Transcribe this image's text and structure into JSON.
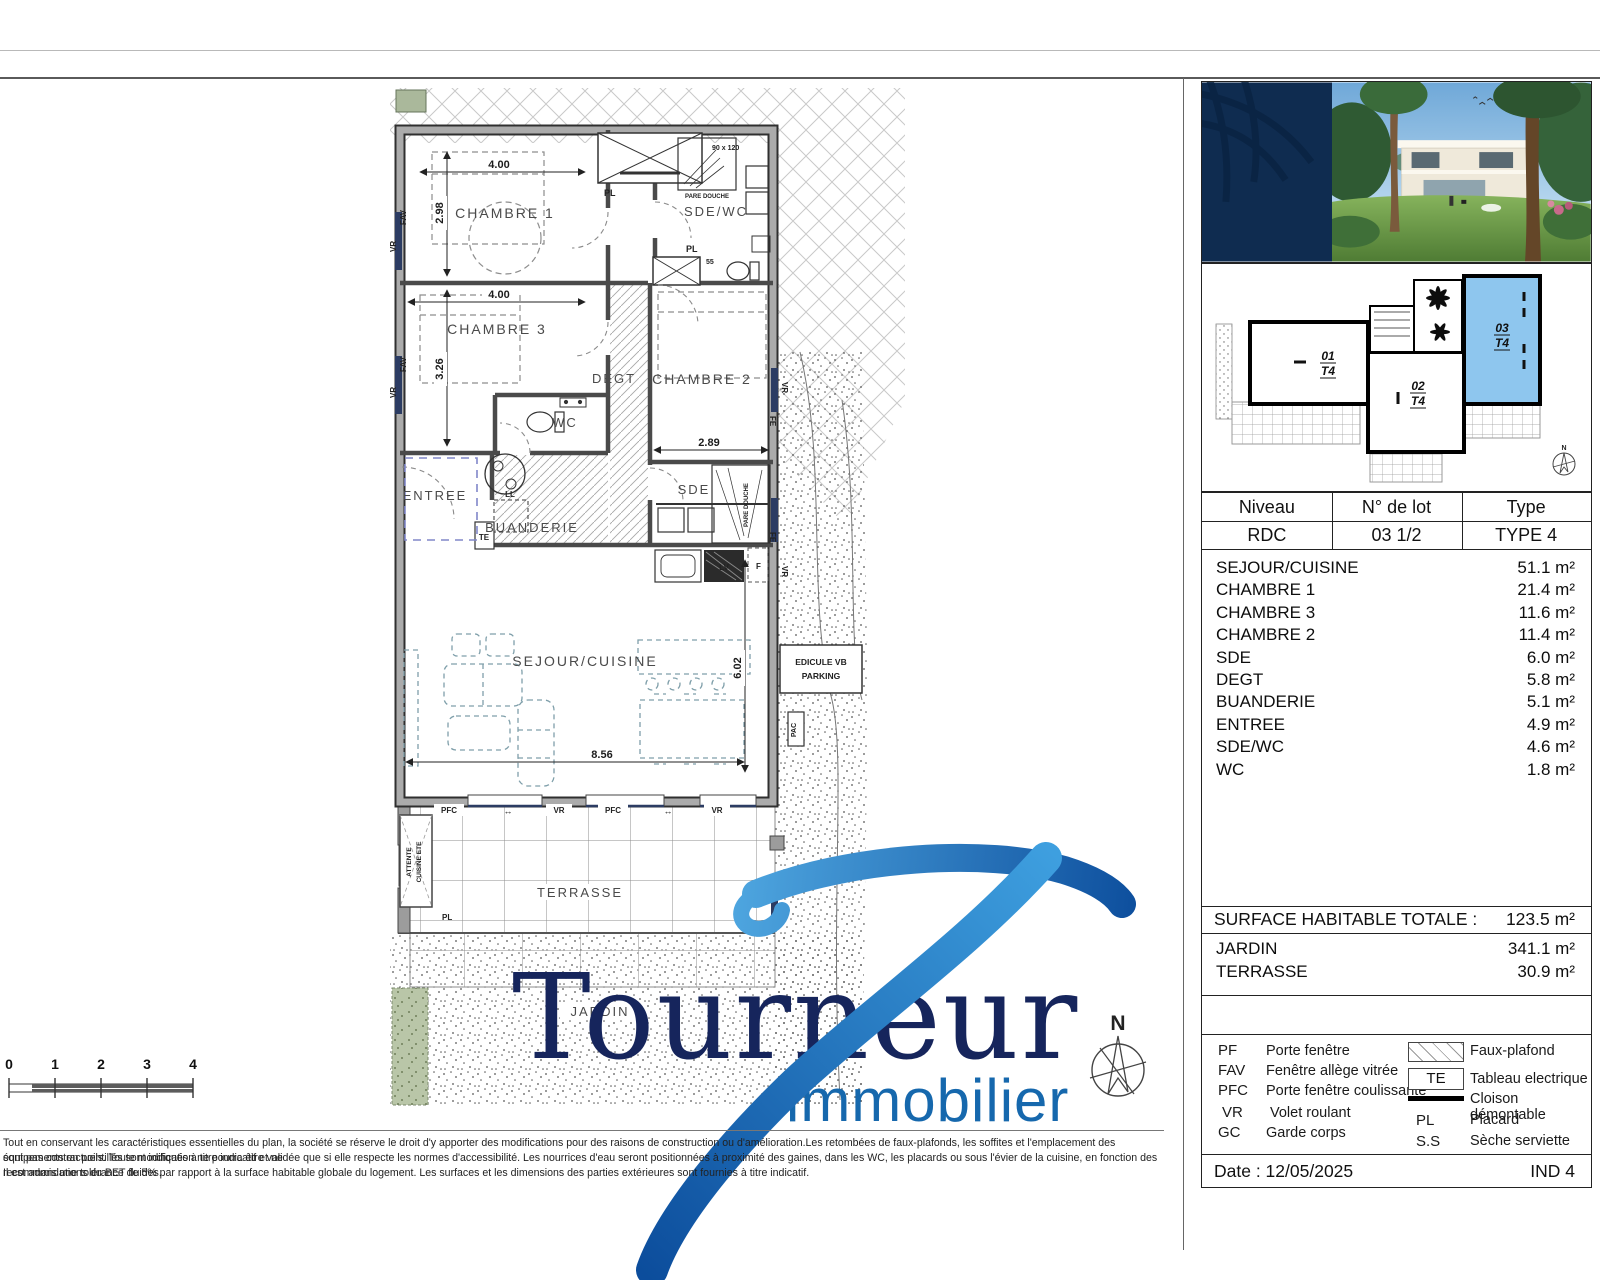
{
  "branding": {
    "name": "Tournéur",
    "subtitle": "immobilier"
  },
  "colors": {
    "brand_navy": "#16255c",
    "brand_blue": "#1668ad",
    "lot_highlight": "#8ec6ee"
  },
  "plan": {
    "rooms": {
      "chambre1": "CHAMBRE 1",
      "chambre2": "CHAMBRE 2",
      "chambre3": "CHAMBRE 3",
      "sde_wc": "SDE/WC",
      "degt": "DEGT",
      "wc": "WC",
      "sde": "SDE",
      "entree": "ENTREE",
      "buanderie": "BUANDERIE",
      "sejour": "SEJOUR/CUISINE",
      "terrasse": "TERRASSE",
      "jardin": "JARDIN"
    },
    "dims": {
      "chambre1_l": "4.00",
      "chambre1_w": "2.98",
      "chambre3_l": "4.00",
      "chambre3_w": "3.26",
      "chambre2_l": "2.89",
      "sejour_l": "8.56",
      "sejour_w": "6.02"
    },
    "tags": {
      "pl": "PL",
      "vr": "VR",
      "fav": "FAV",
      "fe": "FE",
      "pfc": "PFC",
      "te": "TE",
      "ll": "LL",
      "lv": "LV",
      "f": "F",
      "pac": "PAC",
      "pare_douche": "PARE DOUCHE",
      "shower_size": "90 x 120",
      "pl_size": "55",
      "attente_1": "ATTENTE",
      "attente_2": "CUISINE ETE",
      "edicule_1": "EDICULE VB",
      "edicule_2": "PARKING",
      "slide_arrow": "↔",
      "north": "N"
    }
  },
  "siteplan": {
    "lot1_no": "01",
    "lot2_no": "02",
    "lot3_no": "03",
    "type": "T4"
  },
  "sidebar": {
    "info": {
      "headers": [
        "Niveau",
        "N° de lot",
        "Type"
      ],
      "values": [
        "RDC",
        "03 1/2",
        "TYPE 4"
      ]
    },
    "rooms": [
      {
        "name": "SEJOUR/CUISINE",
        "area": "51.1 m²"
      },
      {
        "name": "CHAMBRE 1",
        "area": "21.4 m²"
      },
      {
        "name": "CHAMBRE 3",
        "area": "11.6 m²"
      },
      {
        "name": "CHAMBRE 2",
        "area": "11.4 m²"
      },
      {
        "name": "SDE",
        "area": "6.0 m²"
      },
      {
        "name": "DEGT",
        "area": "5.8 m²"
      },
      {
        "name": "BUANDERIE",
        "area": "5.1 m²"
      },
      {
        "name": "ENTREE",
        "area": "4.9 m²"
      },
      {
        "name": "SDE/WC",
        "area": "4.6 m²"
      },
      {
        "name": "WC",
        "area": "1.8 m²"
      }
    ],
    "total": {
      "label": "SURFACE HABITABLE TOTALE :",
      "value": "123.5 m²"
    },
    "outdoor": [
      {
        "name": "JARDIN",
        "area": "341.1 m²"
      },
      {
        "name": "TERRASSE",
        "area": "30.9 m²"
      }
    ],
    "legend": {
      "left": [
        {
          "code": "PF",
          "label": "Porte fenêtre"
        },
        {
          "code": "FAV",
          "label": "Fenêtre allège vitrée"
        },
        {
          "code": "PFC",
          "label": "Porte fenêtre coulissante"
        },
        {
          "code": "VR",
          "label": "Volet roulant"
        },
        {
          "code": "GC",
          "label": "Garde corps"
        }
      ],
      "faux_plafond": "Faux-plafond",
      "te_code": "TE",
      "te_label": "Tableau electrique",
      "cloison": "Cloison démontable",
      "pl_code": "PL",
      "pl_label": "Placard",
      "ss_code": "S.S",
      "ss_label": "Sèche serviette"
    },
    "footer": {
      "date": "Date : 12/05/2025",
      "ind": "IND 4"
    }
  },
  "scalebar": {
    "ticks": [
      "0",
      "1",
      "2",
      "3",
      "4"
    ]
  },
  "disclaimer": {
    "line1": "Tout en conservant les caractéristiques essentielles du plan, la société se réserve le droit d'y apporter des modifications pour des raisons de construction ou d'amélioration.Les retombées de faux-plafonds, les soffites et l'emplacement des équipements en pointillés sont indiqués à titre indicatif et ne",
    "line2": "sont pas contractuels. Toute modification ne pourra être validée que si elle respecte les normes d'accessibilité. Les nourrices d'eau seront positionnées à proximité des gaines, dans les WC, les placards ou sous l'évier de la cuisine, en fonction des recommandations du BET fluides.",
    "line3": "Il est admis une tolérance de 5% par rapport à la surface habitable globale du logement. Les surfaces et les dimensions des parties extérieures sont fournies à titre indicatif."
  }
}
